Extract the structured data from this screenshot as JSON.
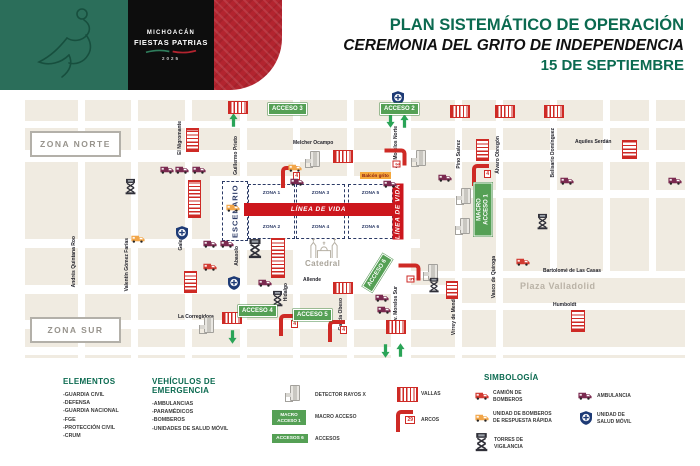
{
  "header": {
    "logo_title": "MICHOACÁN",
    "logo_subtitle": "FIESTAS PATRIAS",
    "logo_year": "2025",
    "title_line1": "PLAN SISTEMÁTICO DE OPERACIÓN",
    "title_line2": "CEREMONIA DEL GRITO DE INDEPENDENCIA",
    "title_line3": "15 DE SEPTIEMBRE",
    "colors": {
      "teal": "#0b6a50",
      "green_block": "#2b6e5a",
      "red_block": "#b3242f",
      "black_block": "#0d0d0d"
    }
  },
  "map": {
    "zona_norte": "ZONA NORTE",
    "zona_sur": "ZONA SUR",
    "escenario": "ESCENARIO",
    "zones": [
      "ZONA 1",
      "ZONA 2",
      "ZONA 3",
      "ZONA 4",
      "ZONA 5",
      "ZONA 6"
    ],
    "linea_de_vida": "LÍNEA DE VIDA",
    "balcon": "Balcón grito",
    "catedral": "Catedral",
    "plaza_valladolid": "Plaza Valladolid",
    "accesos": {
      "acceso2": "ACCESO 2",
      "acceso3": "ACCESO 3",
      "acceso4": "ACCESO 4",
      "acceso5": "ACCESO 5",
      "acceso6": "ACCESO 6",
      "macro_line1": "MACRO",
      "macro_line2": "ACCESO 1"
    },
    "arc_numbers": {
      "melchor": "4",
      "morelos_norte": "3",
      "macro": "4",
      "acceso6": "5",
      "acceso4": "4",
      "acceso5": "4"
    },
    "streets": {
      "nigromante": "El Nigromante",
      "guillermo_prieto": "Guillermo Prieto",
      "melchor_ocampo": "Melcher Ocampo",
      "av_morelos_norte": "Av. Morelos Norte",
      "pino_suarez": "Pino Suárez",
      "alvaro_obregon": "Álvaro Obregón",
      "belisario_dominguez": "Belisario Domínguez",
      "aquiles_serdan": "Aquiles Serdán",
      "andres_quintana_roo": "Andrés Quintana Roo",
      "valentin_gomez_farias": "Valentín Gómez Farías",
      "galeana": "Galeana",
      "abasolo": "Abasolo",
      "allende": "Allende",
      "hidalgo": "Hidalgo",
      "la_corregidora": "La Corregidora",
      "garcia_obeso": "García Obeso",
      "av_morelos_sur": "Av. Morelos Sur",
      "virrey_de_mendoza": "Virrey de Mendoza",
      "vasco_de_quiroga": "Vasco de Quiroga",
      "bartolome": "Bartolomé de Las Casas",
      "humboldt": "Humboldt"
    }
  },
  "legend": {
    "elementos": {
      "title": "ELEMENTOS",
      "items": [
        "-GUARDIA CIVIL",
        "-DEFENSA",
        "-GUARDIA NACIONAL",
        "-FGE",
        "-PROTECCIÓN CIVIL",
        "-CRUM"
      ]
    },
    "vehiculos": {
      "title": "VEHÍCULOS DE EMERGENCIA",
      "items": [
        "-AMBULANCIAS",
        "-PARAMÉDICOS",
        "-BOMBEROS",
        "-UNIDADES DE SALUD MÓVIL"
      ]
    },
    "accesos_col": {
      "detector_label": "DETECTOR RAYOS X",
      "macro_badge_line1": "MACRO",
      "macro_badge_line2": "ACCESO 1",
      "macro_label": "MACRO ACCESO",
      "accesos_badge": "ACCESOS 6",
      "accesos_label": "ACCESOS"
    },
    "barreras_col": {
      "vallas_label": "VALLAS",
      "arcos_count": "29",
      "arcos_label": "ARCOS"
    },
    "simbologia": {
      "title": "SIMBOLOGÍA",
      "items": [
        {
          "icon": "fire-truck-icon",
          "label": "CAMIÓN DE BOMBEROS"
        },
        {
          "icon": "rapid-response-unit-icon",
          "label": "UNIDAD DE BOMBEROS DE RESPUESTA RÁPIDA"
        },
        {
          "icon": "watchtower-icon",
          "label": "TORRES DE VIGILANCIA"
        },
        {
          "icon": "ambulance-icon",
          "label": "AMBULANCIA"
        },
        {
          "icon": "mobile-health-unit-icon",
          "label": "UNIDAD DE SALUD MÓVIL"
        }
      ]
    }
  }
}
